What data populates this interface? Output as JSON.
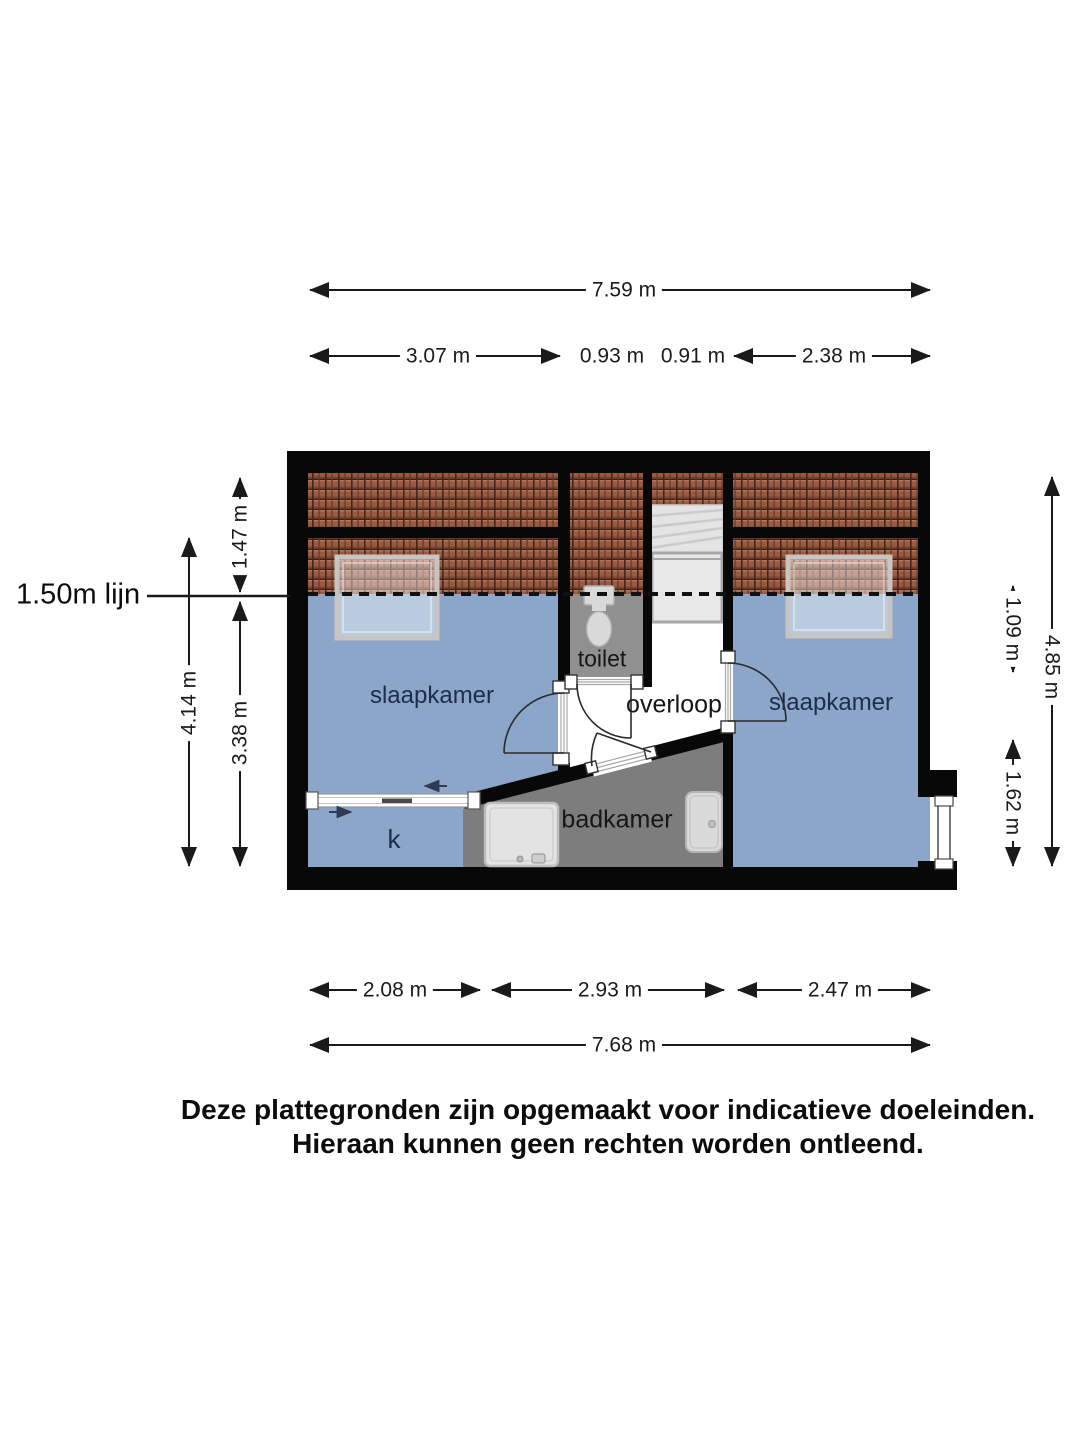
{
  "page": {
    "line150_label": "1.50m lijn",
    "disclaimer_line1": "Deze plattegronden zijn opgemaakt voor indicatieve doeleinden.",
    "disclaimer_line2": "Hieraan kunnen geen rechten worden ontleend."
  },
  "rooms": {
    "bedroom_left": "slaapkamer",
    "bedroom_right": "slaapkamer",
    "toilet": "toilet",
    "landing": "overloop",
    "bathroom": "badkamer",
    "closet": "k"
  },
  "dimensions": {
    "top_total": "7.59 m",
    "top_seg1": "3.07 m",
    "top_seg2": "0.93 m",
    "top_seg3": "0.91 m",
    "top_seg4": "2.38 m",
    "bottom_seg1": "2.08 m",
    "bottom_seg2": "2.93 m",
    "bottom_seg3": "2.47 m",
    "bottom_total": "7.68 m",
    "left_top": "1.47 m",
    "left_full": "4.14 m",
    "left_bottom": "3.38 m",
    "right_top": "1.09 m",
    "right_full": "4.85 m",
    "right_bottom": "1.62 m"
  },
  "colors": {
    "floor_blue": "#8ba6c9",
    "roof_tile": "#9a5a42",
    "bathroom_gray": "#7d7d7d",
    "toilet_gray": "#909090",
    "wall_black": "#080808"
  }
}
